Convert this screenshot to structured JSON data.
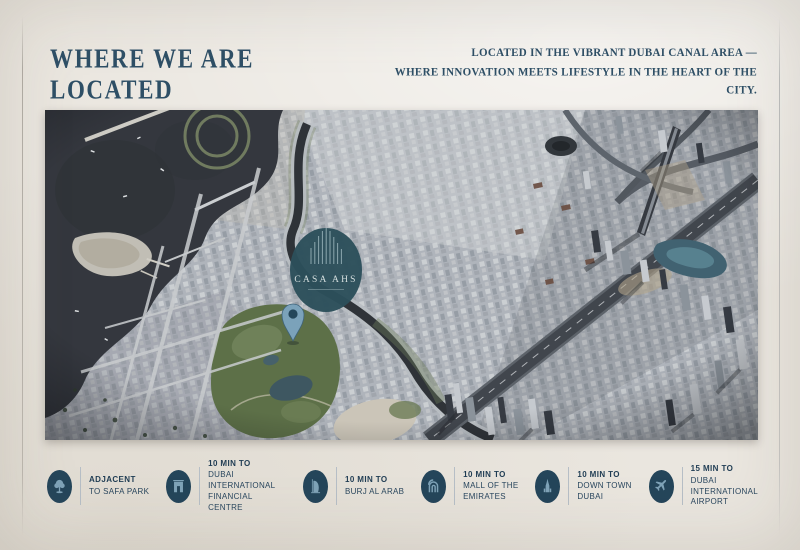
{
  "header": {
    "title": "WHERE WE ARE LOCATED",
    "tagline": "LOCATED IN THE VIBRANT DUBAI CANAL AREA —\nWHERE INNOVATION MEETS LIFESTYLE IN THE HEART OF THE CITY."
  },
  "map": {
    "description": "aerial-view-dubai-canal-area",
    "logo_name": "CASA AHS",
    "marker": "location-pin"
  },
  "badges": [
    {
      "icon": "tree-icon",
      "duration": "ADJACENT",
      "destination": "TO SAFA PARK"
    },
    {
      "icon": "difc-gate-icon",
      "duration": "10 MIN TO",
      "destination": "DUBAI\nINTERNATIONAL\nFINANCIAL CENTRE"
    },
    {
      "icon": "burj-al-arab-icon",
      "duration": "10 MIN TO",
      "destination": "BURJ AL ARAB"
    },
    {
      "icon": "mall-arches-icon",
      "duration": "10 MIN TO",
      "destination": "MALL OF THE\nEMIRATES"
    },
    {
      "icon": "burj-khalifa-icon",
      "duration": "10 MIN TO",
      "destination": "DOWN TOWN\nDUBAI"
    },
    {
      "icon": "airplane-icon",
      "duration": "15 MIN TO",
      "destination": "DUBAI\nINTERNATIONAL\nAIRPORT"
    }
  ],
  "colors": {
    "background": "#eae6df",
    "heading_text": "#2e4f66",
    "badge_circle": "#24455a",
    "badge_icon": "#7fa3b8",
    "badge_text": "#1f3c53",
    "map_logo_circle": "#2c4f5b",
    "map_pin": "#7ba2ba"
  }
}
